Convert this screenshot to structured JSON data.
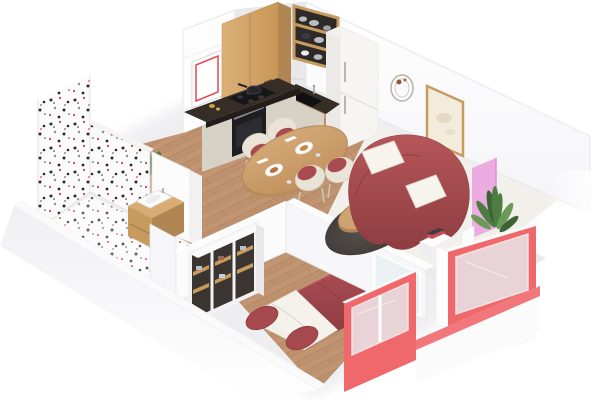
{
  "scene": {
    "type": "isometric-3d-floor-plan-render",
    "description": "3D isometric cutaway render of a studio apartment floor plan with red accent furniture",
    "rooms": [
      {
        "name": "bathroom",
        "position": "top-left",
        "objects": [
          "terrazzo speckled walls",
          "terrazzo floor",
          "wood vanity with white sink",
          "green plant",
          "small red toy"
        ]
      },
      {
        "name": "kitchen",
        "position": "top-center",
        "objects": [
          "wood upper cabinet",
          "marble backsplash",
          "open wood shelf with metal cookware",
          "white fridge",
          "dark stone L-counter",
          "black cooktop with pan",
          "black oven",
          "beige base cabinets",
          "red-bordered wall frame"
        ]
      },
      {
        "name": "dining-area",
        "position": "center",
        "objects": [
          "oval wood table",
          "four cream chairs with red cushions",
          "white plates with food",
          "napkins"
        ]
      },
      {
        "name": "living-room",
        "position": "right",
        "objects": [
          "curved red sofa",
          "two white pillows",
          "round wood coffee table with vase",
          "dark round rug",
          "framed wall art",
          "round wall decor",
          "pink accent panel",
          "potted plant in white pot",
          "book stack side table"
        ]
      },
      {
        "name": "bedroom",
        "position": "bottom-center",
        "objects": [
          "double bed with red duvet",
          "white folded sheet",
          "two red pillows",
          "open wardrobe with wood shelves and folded clothes",
          "wood plank floor"
        ]
      },
      {
        "name": "balcony",
        "position": "bottom-right",
        "objects": [
          "glass railing",
          "coral-red framed windows",
          "gray balcony floor"
        ]
      }
    ]
  },
  "palette": {
    "wall-white": "#fdfdfe",
    "wall-shade": "#f2f2f5",
    "wall-edge": "#e7e7ea",
    "terrazzo-base": "#fbfafa",
    "speck-black": "#2b2b30",
    "speck-red": "#c04a50",
    "speck-gray": "#8a8a92",
    "wood-light": "#d9ac74",
    "wood-mid": "#c79a5e",
    "wood-dark": "#b08752",
    "floor-wood": "#c39673",
    "floor-wood-line": "#a87e5d",
    "counter-dark": "#362d27",
    "cooktop-black": "#17171a",
    "appliance-black": "#1e1e22",
    "cabinet-beige": "#d7d2c6",
    "fridge-white": "#f6f5f2",
    "marble-light": "#e9e9ec",
    "marble-dark": "#cfcfd6",
    "chair-cream": "#eae4d8",
    "chair-red": "#a84b50",
    "table-wood": "#cfa271",
    "sofa-red": "#a84c4f",
    "sofa-red-dark": "#8f3e42",
    "pillow-white": "#f7f4ee",
    "rug-dark": "#514c49",
    "accent-pink": "#ecace2",
    "plant-green": "#4e7d44",
    "plant-green-dark": "#3c6336",
    "plant-green-light": "#6a9a58",
    "pot-white": "#f7f7f5",
    "window-red": "#ef686c",
    "glass-blue": "#e7eef2",
    "bed-red": "#a5494e",
    "bed-red-dark": "#8c3c42",
    "sheet-white": "#f5f2ec",
    "floor-cream": "#f2f0ea",
    "balcony-gray": "#e9eaec",
    "art-cream": "#f3ecdc",
    "metal-gray": "#b9bcc0",
    "frame-red": "#e8474f"
  }
}
